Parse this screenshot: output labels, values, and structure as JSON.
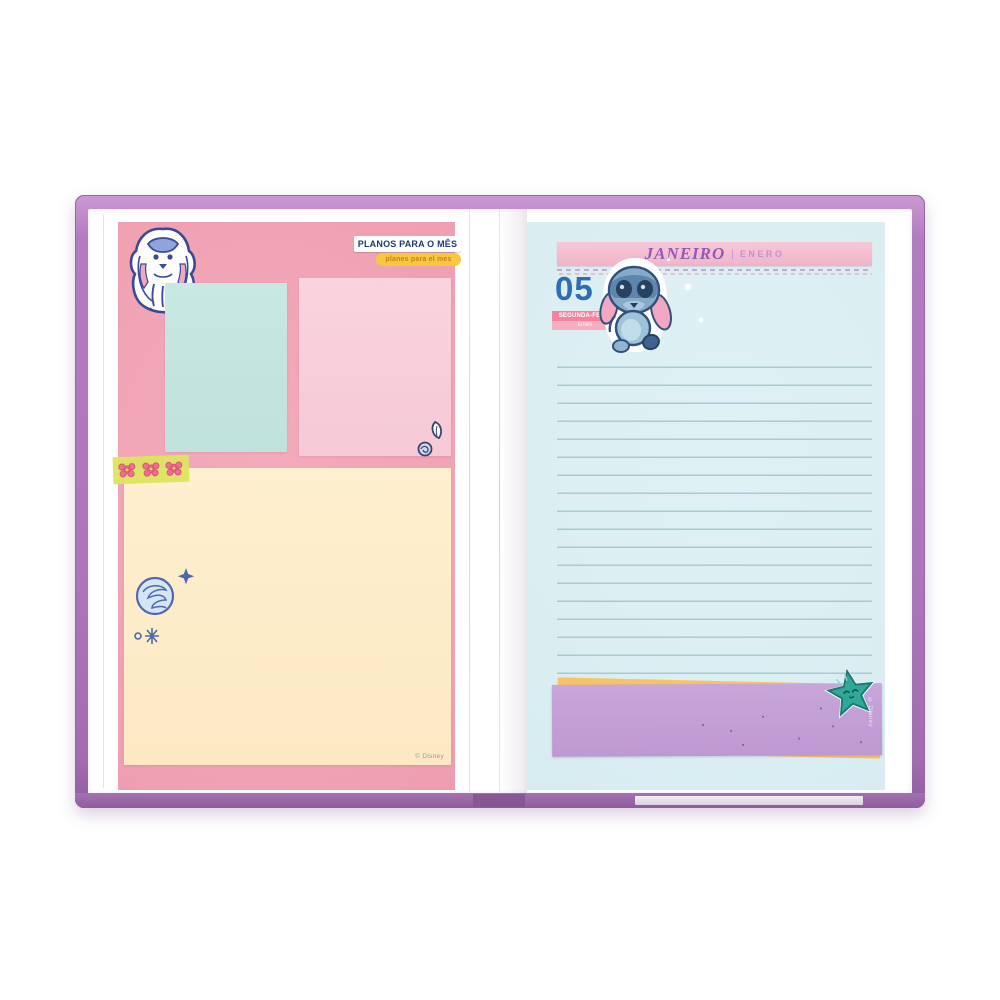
{
  "left_page": {
    "plans_label": "PLANOS PARA O MÊS",
    "plans_sublabel": "planes para el mes",
    "copyright": "© Disney",
    "stickers": {
      "top_left": "stitch-lineart-doodle-sticker",
      "washi": "flower-washi-tape",
      "doodles": [
        "scribble-ball-doodle",
        "sparkle-doodle",
        "leaf-doodle"
      ]
    }
  },
  "right_page": {
    "month": "JANEIRO",
    "month_divider": "|",
    "month_es": "ENERO",
    "day_number": "05",
    "weekday_pt": "SEGUNDA-FEIRA",
    "weekday_es": "lunes",
    "copyright": "© Disney",
    "stickers": {
      "character": "stitch-sticker",
      "bottom_banner": "star-face-sticker"
    }
  },
  "colors": {
    "cover_purple": "#b27cc0",
    "left_sheet_pink": "#f0a2b3",
    "mint_note": "#c3e5df",
    "pink_note": "#f8cfda",
    "cream_note": "#fdedca",
    "right_sheet_cyan": "#daeef2",
    "ruled_line": "#a9cad3",
    "header_banner_pink": "#f3bccd",
    "header_text_purple": "#8d5cb8",
    "day_blue": "#2e6cb5",
    "weekday_pink": "#f2849f",
    "bottom_banner_purple": "#c3a1d7",
    "accent_orange": "#f8c364",
    "star_teal": "#2fa89a",
    "washi_green": "#dce45f"
  }
}
